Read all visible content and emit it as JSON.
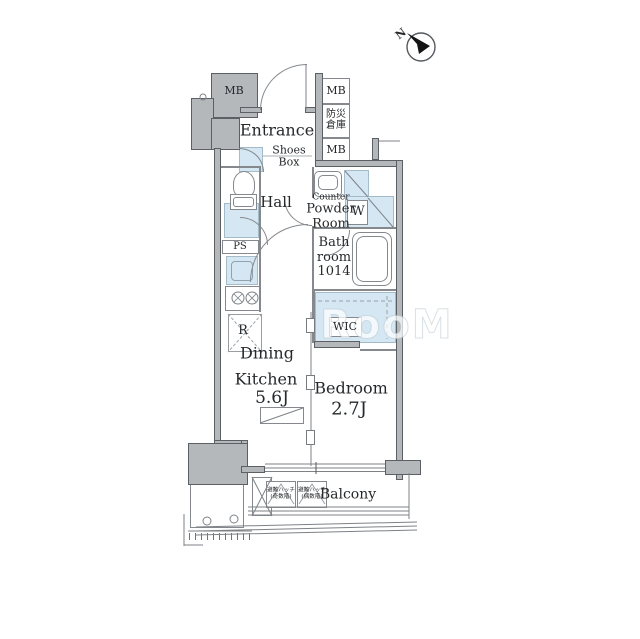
{
  "compass": {
    "north_label": "N"
  },
  "watermark": "RooM",
  "meter_boxes": {
    "top_left": "MB",
    "right_top": "MB",
    "right_bottom": "MB"
  },
  "storage": {
    "bousai_line1": "防災",
    "bousai_line2": "倉庫"
  },
  "rooms": {
    "entrance": {
      "label": "Entrance",
      "shoes_line1": "Shoes",
      "shoes_line2": "Box"
    },
    "hall": {
      "label": "Hall"
    },
    "powder_room": {
      "line1": "Counter",
      "line2": "Powder",
      "line3": "Room"
    },
    "washer": {
      "label": "W"
    },
    "bathroom": {
      "line1": "Bath",
      "line2": "room",
      "line3": "1014"
    },
    "pipe_space": {
      "label": "PS"
    },
    "refrigerator": {
      "label": "R"
    },
    "wic": {
      "label": "WIC"
    },
    "dining_kitchen": {
      "line1": "Dining",
      "line2": "Kitchen",
      "size": "5.6J"
    },
    "bedroom": {
      "label": "Bedroom",
      "size": "2.7J"
    },
    "balcony": {
      "label": "Balcony"
    }
  },
  "balcony_hatches": [
    {
      "line1": "避難ハッチ",
      "line2": "(奇数階)"
    },
    {
      "line1": "避難ハッチ",
      "line2": "(偶数階)"
    }
  ],
  "colors": {
    "wall_fill": "#b4b8bb",
    "wall_edge": "#5c6064",
    "wet_area": "#d4e7f2",
    "linework": "#7d8288",
    "text": "#26292c",
    "watermark": "#dfe6ea"
  }
}
